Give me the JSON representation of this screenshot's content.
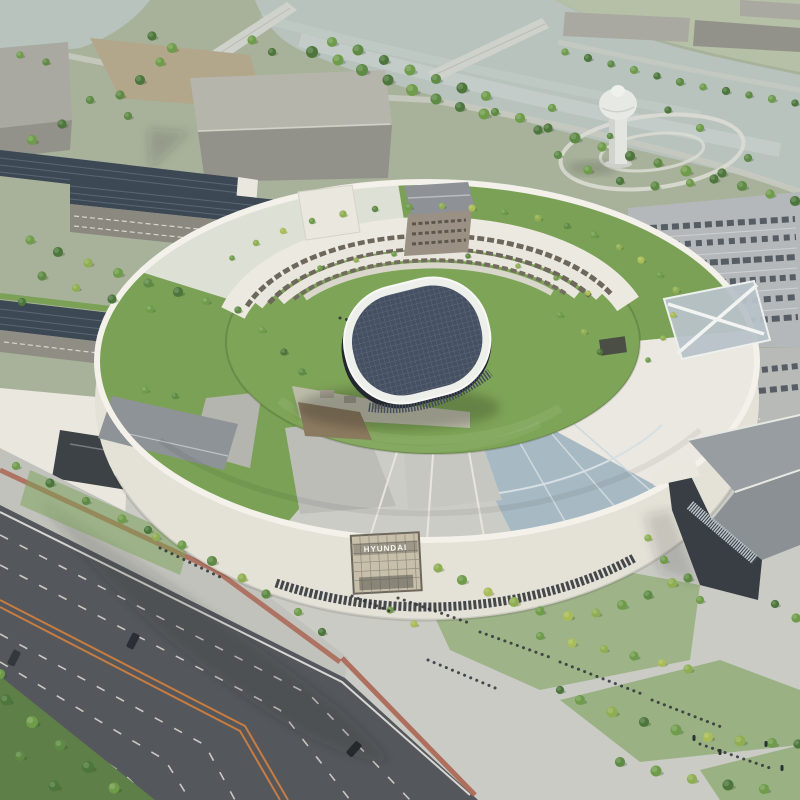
{
  "sign": {
    "label": "HYUNDAI"
  },
  "colors": {
    "terrain": "#a8b29b",
    "terrainLight": "#b6c0a6",
    "water": "#b8c3be",
    "plaza": "#cacbc5",
    "sidewalk": "#c1c2bb",
    "road": "#54585c",
    "roadLine": "#dddcd6",
    "roadCenter": "#c97c3f",
    "brick": "#a95f4c",
    "lawn": "#7aa156",
    "facade": "#eae7df",
    "wall": "#e4e1d7",
    "paving": "#cbccc6",
    "glassRoof": "#a7b9c3",
    "solar": "#3d4855",
    "parking": "#b4b8ba",
    "carDark": "#565d64",
    "grayRoof": "#979da0",
    "darkFacade": "#393e44",
    "warehouse": "#a9a9a1",
    "warehouseDark": "#92928a",
    "dirt": "#b2a68b",
    "tower": "#e2e5e0",
    "ovalRoof": "#455062",
    "ovalRim": "#edefeb",
    "ovalBase": "#23272e",
    "treeDark": "#4d763c",
    "tree": "#6f9c4a",
    "treeLight": "#8fae52",
    "treeYellow": "#a9bc55",
    "treeDeep": "#5e8a45",
    "signBg": "#c8bfab",
    "signText": "#f7f7f2"
  }
}
